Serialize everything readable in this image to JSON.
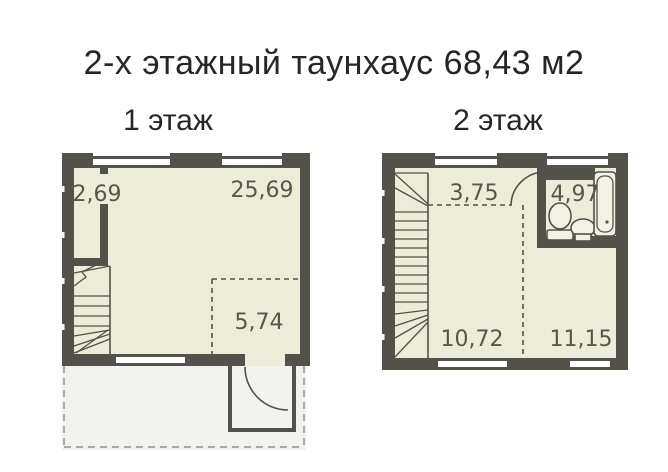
{
  "title": "2-х этажный таунхаус 68,43 м2",
  "floors": {
    "floor1": {
      "label": "1 этаж",
      "rooms": {
        "hall": "2,69",
        "living": "25,69",
        "kitchen_zone": "5,74"
      }
    },
    "floor2": {
      "label": "2 этаж",
      "rooms": {
        "hall": "3,75",
        "bathroom": "4,97",
        "room_left": "10,72",
        "room_right": "11,15"
      }
    }
  },
  "colors": {
    "wall": "#54514a",
    "floor_fill": "#edecd9",
    "room_label": "#5a564b",
    "terrace_fill": "#f2f2f0",
    "title_text": "#262626"
  }
}
